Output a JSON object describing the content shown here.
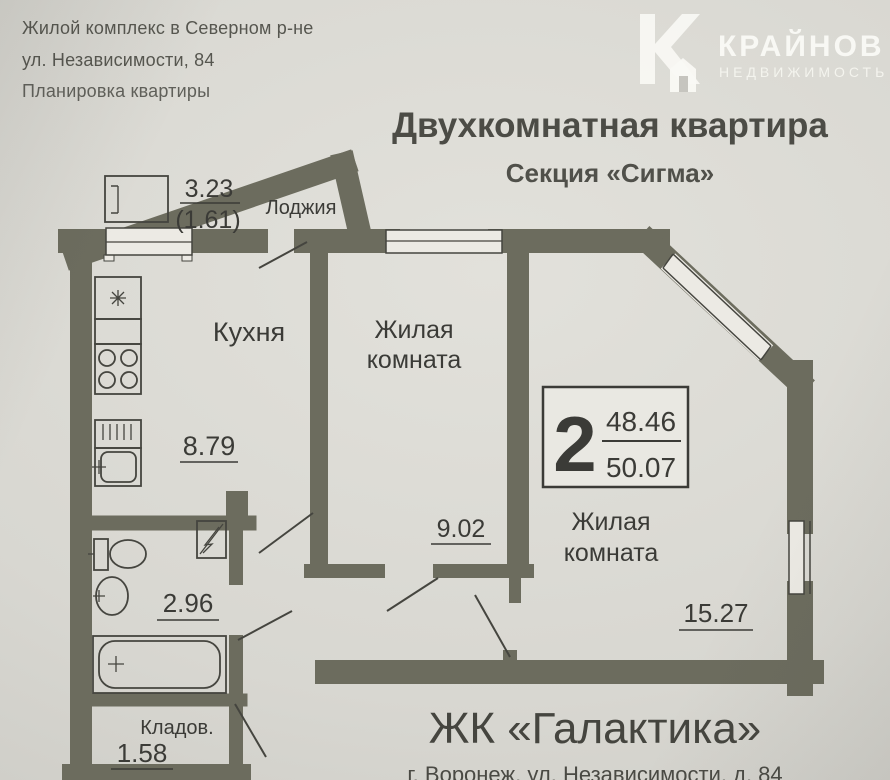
{
  "header": {
    "line1": "Жилой комплекс в Северном р-не",
    "line2": "ул. Независимости, 84",
    "line3": "Планировка квартиры"
  },
  "logo": {
    "brand": "КРАЙНОВ",
    "tagline": "НЕДВИЖИМОСТЬ"
  },
  "title": {
    "main": "Двухкомнатная квартира",
    "section": "Секция «Сигма»"
  },
  "plan": {
    "loggia": {
      "label": "Лоджия",
      "area_full": "3.23",
      "area_reduced": "(1.61)"
    },
    "kitchen": {
      "label": "Кухня",
      "area": "8.79"
    },
    "room1": {
      "label_line1": "Жилая",
      "label_line2": "комната",
      "area": "9.02"
    },
    "room2": {
      "label_line1": "Жилая",
      "label_line2": "комната",
      "area": "15.27"
    },
    "bathroom": {
      "area": "2.96"
    },
    "storage": {
      "label": "Кладов.",
      "area": "1.58"
    },
    "badge": {
      "rooms_count": "2",
      "area_living": "48.46",
      "area_total": "50.07"
    }
  },
  "footer": {
    "complex_name": "ЖК «Галактика»",
    "address": "г. Воронеж, ул. Независимости, д. 84"
  },
  "colors": {
    "paper": "#d8d7d1",
    "wall": "#6c6c5e",
    "line": "#3b3b37",
    "window_fill": "#eceae4"
  }
}
